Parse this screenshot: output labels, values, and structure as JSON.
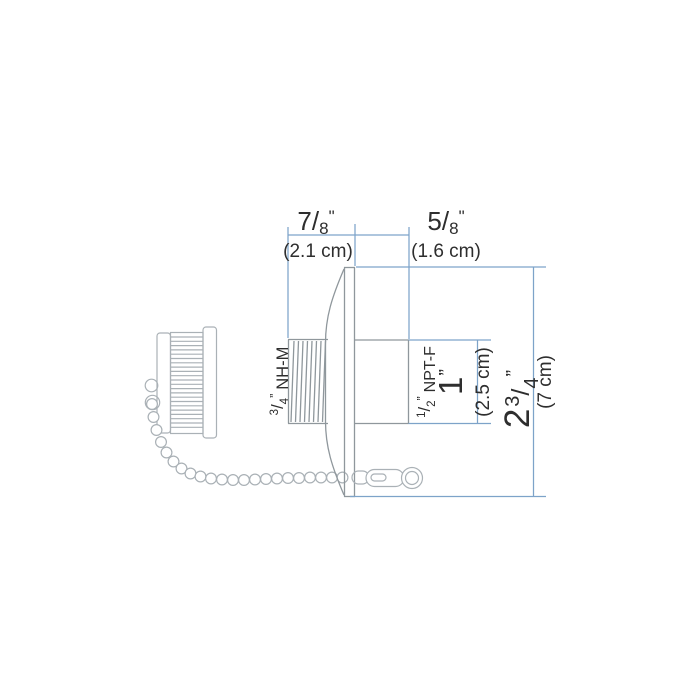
{
  "diagram": {
    "labels": {
      "width_thread": {
        "num": "7",
        "slash": "/",
        "den": "8",
        "unit": "\"",
        "metric": "(2.1 cm)"
      },
      "width_npt": {
        "num": "5",
        "slash": "/",
        "den": "8",
        "unit": "\"",
        "metric": "(1.6 cm)"
      },
      "male_thread": {
        "num": "3",
        "slash": "/",
        "den": "4",
        "unit": "”",
        "name": "NH-M"
      },
      "female_thread": {
        "num": "1",
        "slash": "/",
        "den": "2",
        "unit": "”",
        "name": "NPT-F"
      },
      "npt_bore": {
        "value": "1",
        "unit": "”",
        "metric": "(2.5 cm)"
      },
      "overall": {
        "whole": "2",
        "num": "3",
        "slash": "/",
        "den": "4",
        "unit": "”",
        "metric": "(7 cm)"
      }
    }
  },
  "colors": {
    "dimension_line": "#7da3c9",
    "part_line": "#8f979c",
    "accessory_line": "#aab1b6",
    "label_text": "#2e2e2e",
    "background": "#ffffff"
  }
}
